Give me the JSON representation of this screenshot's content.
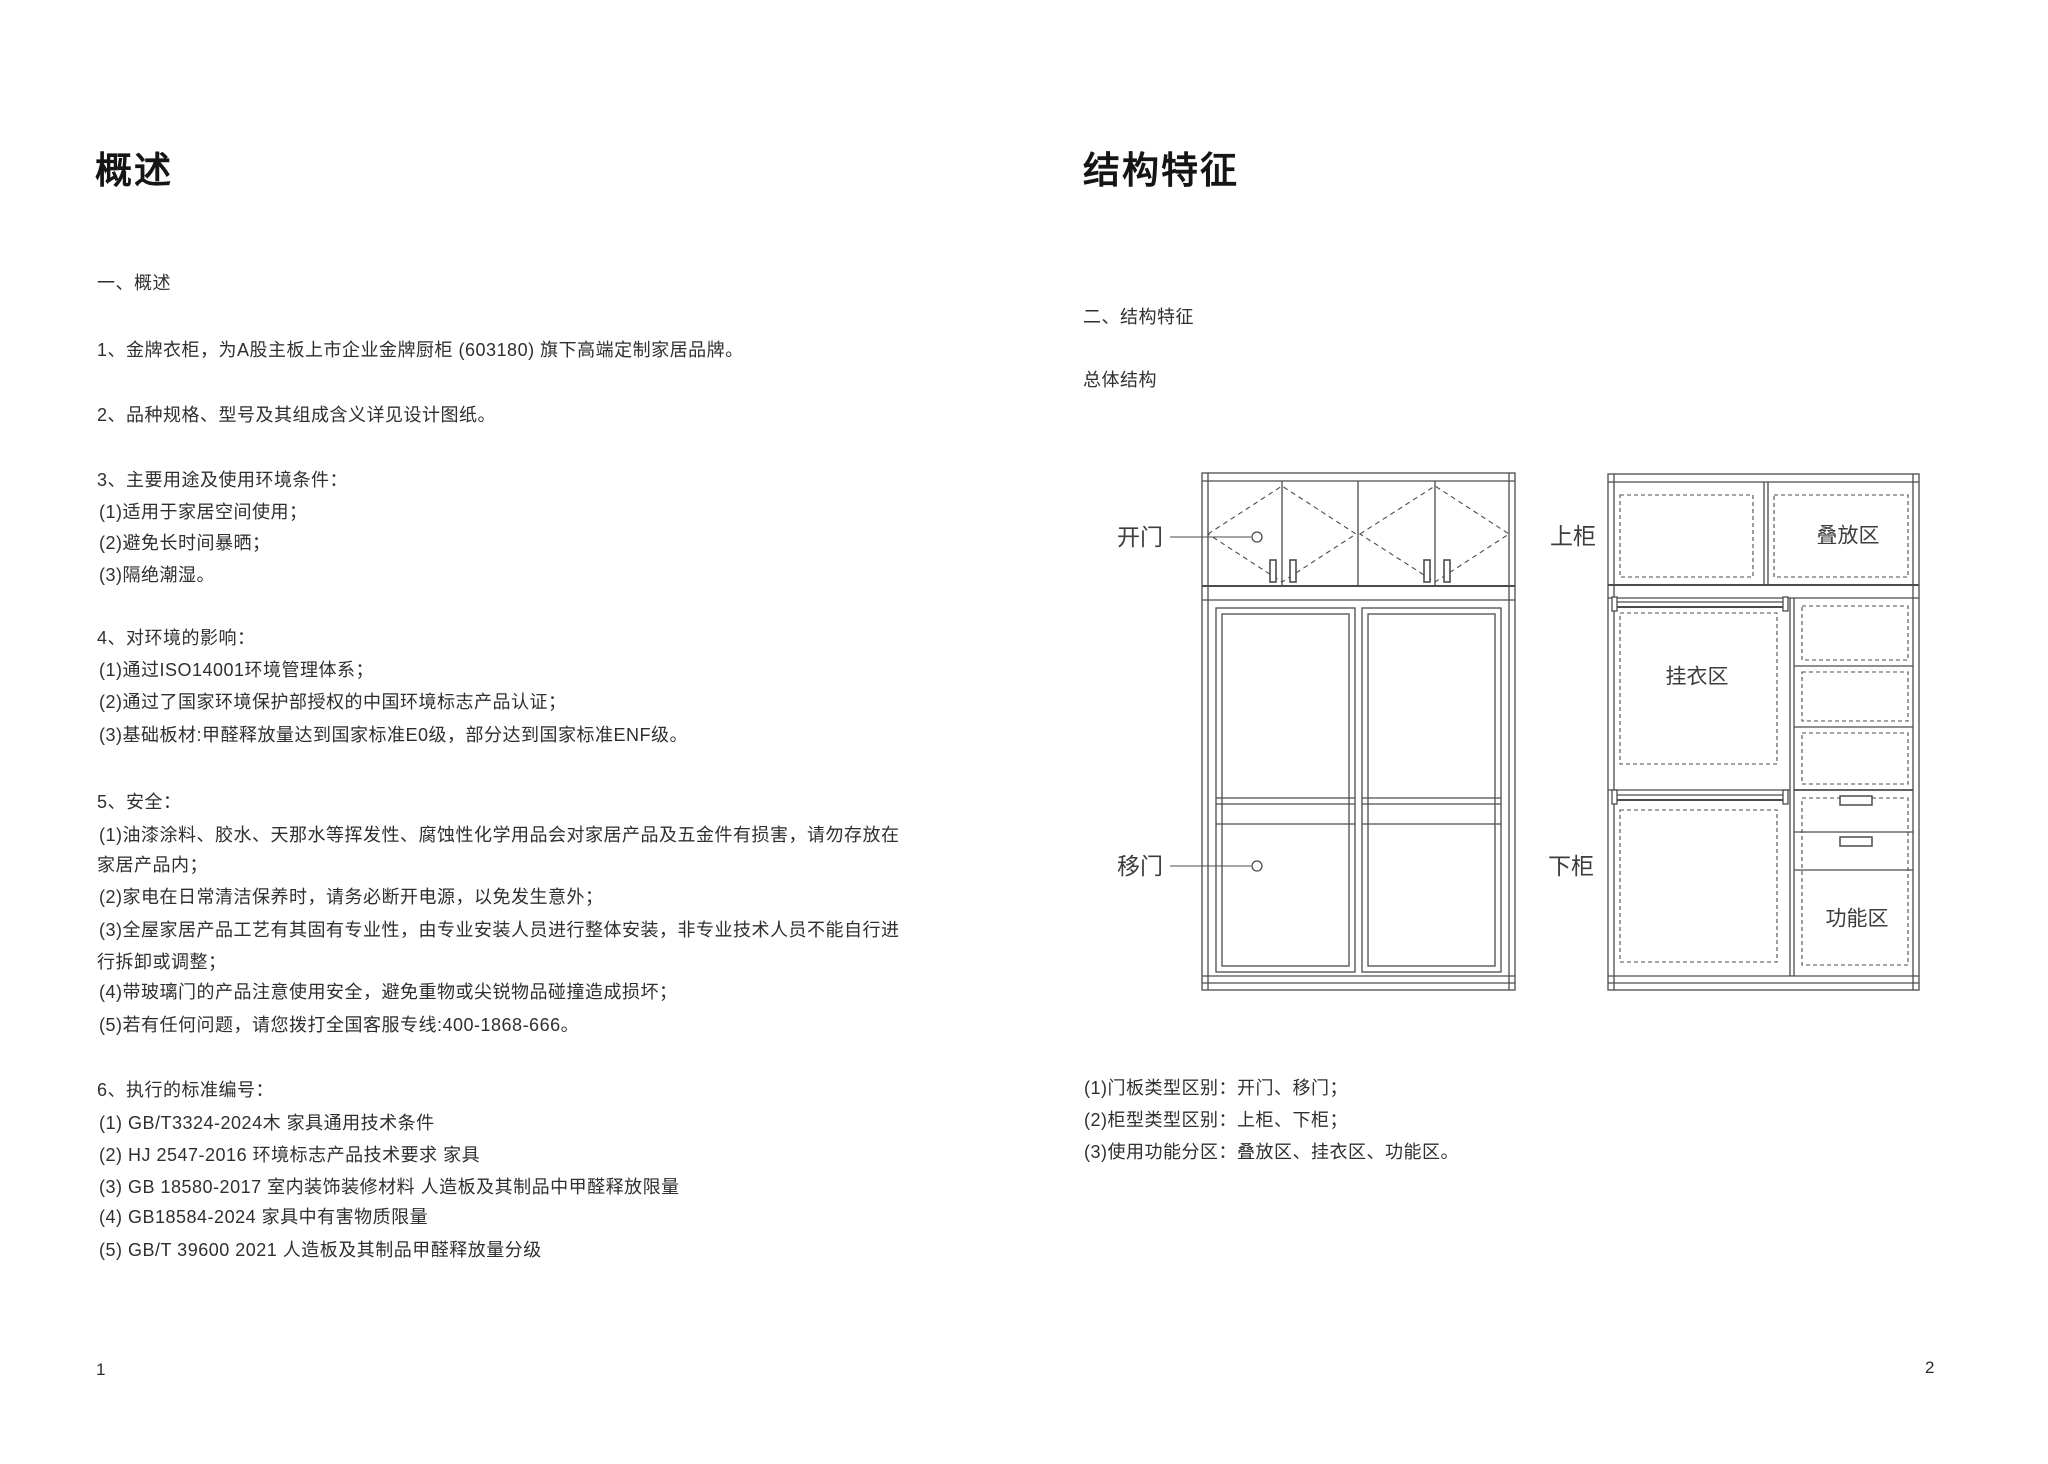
{
  "page_left": {
    "title": "概述",
    "page_number": "1",
    "lines": [
      "一、概述",
      "1、金牌衣柜，为A股主板上市企业金牌厨柜 (603180) 旗下高端定制家居品牌。",
      "2、品种规格、型号及其组成含义详见设计图纸。",
      "3、主要用途及使用环境条件：",
      "(1)适用于家居空间使用；",
      "(2)避免长时间暴晒；",
      "(3)隔绝潮湿。",
      "4、对环境的影响：",
      "(1)通过ISO14001环境管理体系；",
      "(2)通过了国家环境保护部授权的中国环境标志产品认证；",
      "(3)基础板材:甲醛释放量达到国家标准E0级，部分达到国家标准ENF级。",
      "5、安全：",
      "(1)油漆涂料、胶水、天那水等挥发性、腐蚀性化学用品会对家居产品及五金件有损害，请勿存放在",
      "家居产品内；",
      "(2)家电在日常清洁保养时，请务必断开电源，以免发生意外；",
      "(3)全屋家居产品工艺有其固有专业性，由专业安装人员进行整体安装，非专业技术人员不能自行进",
      "行拆卸或调整；",
      "(4)带玻璃门的产品注意使用安全，避免重物或尖锐物品碰撞造成损坏；",
      "(5)若有任何问题，请您拨打全国客服专线:400-1868-666。",
      "6、执行的标准编号：",
      "(1) GB/T3324-2024木 家具通用技术条件",
      "(2) HJ 2547-2016 环境标志产品技术要求 家具",
      "(3) GB 18580-2017 室内装饰装修材料 人造板及其制品中甲醛释放限量",
      "(4) GB18584-2024 家具中有害物质限量",
      "(5) GB/T 39600 2021 人造板及其制品甲醛释放量分级"
    ]
  },
  "page_right": {
    "title": "结构特征",
    "page_number": "2",
    "section_heading": "二、结构特征",
    "sub_heading": "总体结构",
    "notes": [
      "(1)门板类型区别：开门、移门；",
      "(2)柜型类型区别：上柜、下柜；",
      "(3)使用功能分区：叠放区、挂衣区、功能区。"
    ],
    "diagram": {
      "labels": {
        "open_door": "开门",
        "sliding_door": "移门",
        "upper_cabinet": "上柜",
        "lower_cabinet": "下柜",
        "stack_zone": "叠放区",
        "hanging_zone": "挂衣区",
        "function_zone": "功能区"
      },
      "line_color": "#4c4c4c"
    }
  }
}
